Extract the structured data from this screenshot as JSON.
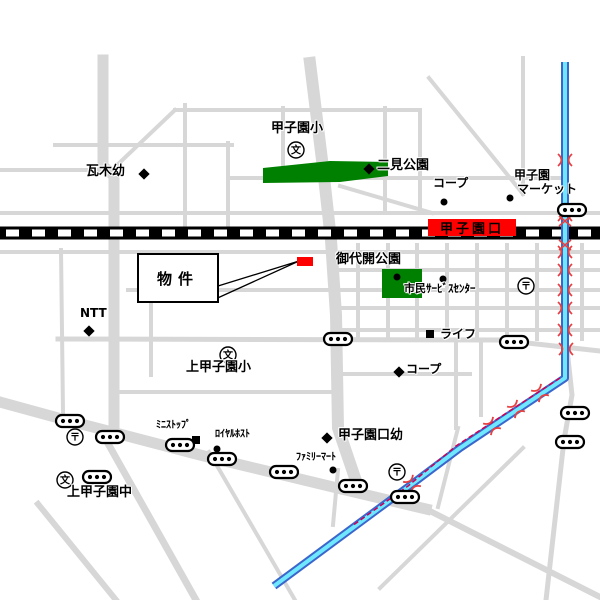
{
  "map": {
    "station": {
      "label": "甲子園口"
    },
    "property": {
      "label": "物件"
    },
    "places": {
      "koshien_elementary": "甲子園小",
      "futami_park": "二見公園",
      "kawaragi_kindergarten": "瓦木幼",
      "coop_north": "コープ",
      "koshien_market_line1": "甲子園",
      "koshien_market_line2": "マーケット",
      "miyobiraki_park": "御代開公園",
      "civic_service_center": "市民ｻｰﾋﾞｽｾﾝﾀｰ",
      "life": "ライフ",
      "coop_south": "コープ",
      "ntt": "NTT",
      "kami_koshien_elementary": "上甲子園小",
      "ministop": "ﾐﾆｽﾄｯﾌﾟ",
      "royal_host": "ﾛｲﾔﾙﾎｽﾄ",
      "koshienguchi_kindergarten": "甲子園口幼",
      "family_mart": "ﾌｧﾐﾘｰﾏｰﾄ",
      "kami_koshien_junior_high": "上甲子園中"
    },
    "icons": {
      "school_symbol": "文",
      "post_office_symbol": "〒"
    },
    "colors": {
      "road": "#d7d7d7",
      "park_green": "#008000",
      "station_bg": "#ff0000",
      "property_marker": "#ff0000",
      "river_edge": "#3b66cc",
      "river_fill": "#6fe8ff",
      "bridge_red": "#e8403f",
      "railway": "#000000"
    }
  }
}
